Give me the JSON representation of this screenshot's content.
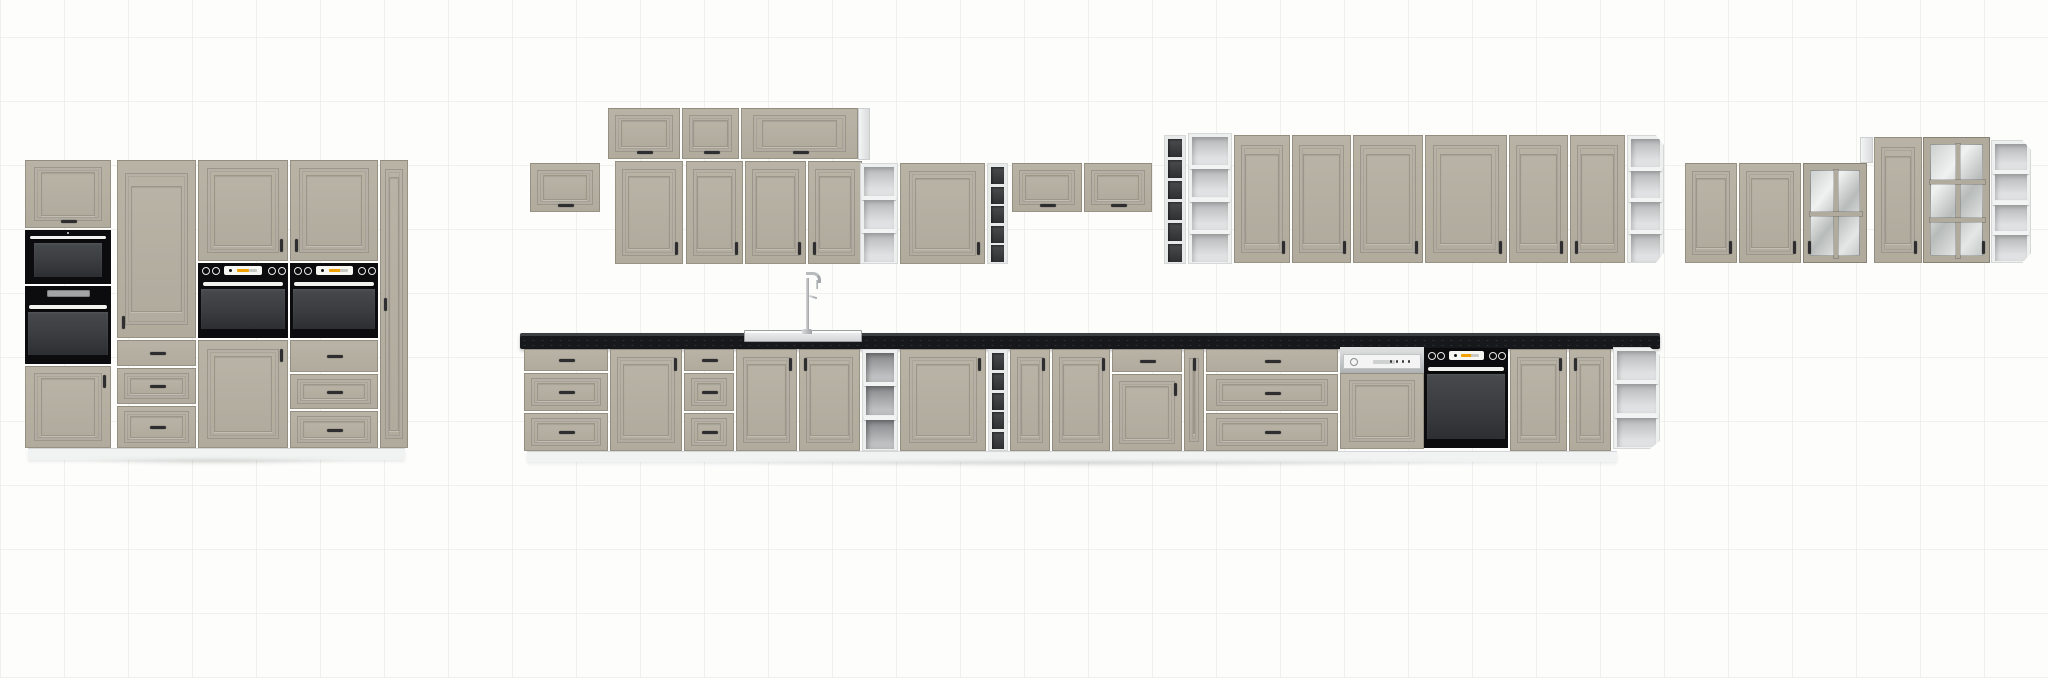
{
  "scene": {
    "label": "kitchen-cabinet-set-elevation-render",
    "canvas": {
      "width": 2048,
      "height": 678
    },
    "background": {
      "base": "#fdfdfc",
      "grid_line": "#f1f1ee",
      "grid_size_px": 64
    },
    "palette": {
      "front_hi": "#b9b3a6",
      "front_lo": "#b1ab9e",
      "front_groove": "#9c968a",
      "carcass": "#eef0f0",
      "countertop": "#17181b",
      "countertop_edge": "#3c3e42",
      "appliance_black": "#0c0c0e",
      "oven_glass": "#3e4043",
      "handle": "#2e2e30",
      "steel": "#c3c6c7",
      "display_orange": "#f2a200",
      "plinth": "#f1f3f3",
      "floor_shadow": "rgba(0,0,0,0.12)"
    },
    "modules": [
      {
        "t": "flap",
        "x": 25,
        "y": 160,
        "w": 86,
        "h": 68,
        "hd": "hbc"
      },
      {
        "t": "microwave",
        "x": 25,
        "y": 230,
        "w": 86,
        "h": 54
      },
      {
        "t": "oven",
        "x": 25,
        "y": 286,
        "w": 86,
        "h": 78,
        "style": "display"
      },
      {
        "t": "door",
        "x": 25,
        "y": 366,
        "w": 86,
        "h": 82,
        "hd": "vtr"
      },
      {
        "t": "door",
        "x": 117,
        "y": 160,
        "w": 79,
        "h": 178,
        "hd": "vbl"
      },
      {
        "t": "drawers",
        "x": 117,
        "y": 340,
        "w": 79,
        "h": 108,
        "rows": [
          [
            0,
            26,
            0
          ],
          [
            28,
            36,
            1
          ],
          [
            66,
            42,
            1
          ]
        ]
      },
      {
        "t": "door",
        "x": 198,
        "y": 160,
        "w": 90,
        "h": 101,
        "hd": "vbr"
      },
      {
        "t": "oven",
        "x": 198,
        "y": 263,
        "w": 90,
        "h": 75,
        "style": "knobs"
      },
      {
        "t": "door",
        "x": 198,
        "y": 340,
        "w": 90,
        "h": 108,
        "hd": "vtr"
      },
      {
        "t": "door",
        "x": 290,
        "y": 160,
        "w": 88,
        "h": 101,
        "hd": "vbl"
      },
      {
        "t": "oven",
        "x": 290,
        "y": 263,
        "w": 88,
        "h": 75,
        "style": "knobs"
      },
      {
        "t": "drawers",
        "x": 290,
        "y": 340,
        "w": 88,
        "h": 108,
        "rows": [
          [
            0,
            32,
            0
          ],
          [
            34,
            35,
            1
          ],
          [
            71,
            37,
            1
          ]
        ]
      },
      {
        "t": "door",
        "x": 380,
        "y": 160,
        "w": 28,
        "h": 288,
        "hd": "vml",
        "slim": 1
      },
      {
        "t": "plinth",
        "x": 28,
        "y": 448,
        "w": 377,
        "h": 12
      },
      {
        "t": "shadow",
        "x": 18,
        "y": 459,
        "w": 397,
        "h": 9
      },
      {
        "t": "flap",
        "x": 530,
        "y": 163,
        "w": 70,
        "h": 49,
        "hd": "hbc"
      },
      {
        "t": "flap",
        "x": 608,
        "y": 108,
        "w": 72,
        "h": 51,
        "hd": "hbc"
      },
      {
        "t": "flap",
        "x": 682,
        "y": 108,
        "w": 57,
        "h": 51,
        "hd": "hbc"
      },
      {
        "t": "flap",
        "x": 741,
        "y": 108,
        "w": 117,
        "h": 51,
        "hd": "hbc"
      },
      {
        "t": "side",
        "x": 858,
        "y": 108,
        "w": 12,
        "h": 52
      },
      {
        "t": "door",
        "x": 615,
        "y": 161,
        "w": 68,
        "h": 103,
        "hd": "vbr"
      },
      {
        "t": "door",
        "x": 686,
        "y": 161,
        "w": 57,
        "h": 103,
        "hd": "vbr"
      },
      {
        "t": "door",
        "x": 745,
        "y": 161,
        "w": 61,
        "h": 103,
        "hd": "vbr"
      },
      {
        "t": "door",
        "x": 808,
        "y": 161,
        "w": 54,
        "h": 103,
        "hd": "vbl"
      },
      {
        "t": "openshelf",
        "x": 860,
        "y": 163,
        "w": 38,
        "h": 101,
        "cells": 3,
        "interior": "light"
      },
      {
        "t": "door",
        "x": 900,
        "y": 163,
        "w": 85,
        "h": 101,
        "hd": "vbr"
      },
      {
        "t": "cubbies",
        "x": 987,
        "y": 163,
        "w": 21,
        "h": 101,
        "cells": 5
      },
      {
        "t": "flap",
        "x": 1012,
        "y": 163,
        "w": 70,
        "h": 49,
        "hd": "hbc"
      },
      {
        "t": "flap",
        "x": 1084,
        "y": 163,
        "w": 68,
        "h": 49,
        "hd": "hbc"
      },
      {
        "t": "cubbies",
        "x": 1164,
        "y": 135,
        "w": 22,
        "h": 129,
        "cells": 6
      },
      {
        "t": "openshelf",
        "x": 1188,
        "y": 133,
        "w": 44,
        "h": 131,
        "cells": 4,
        "interior": "light"
      },
      {
        "t": "door",
        "x": 1234,
        "y": 135,
        "w": 56,
        "h": 128,
        "hd": "vbr"
      },
      {
        "t": "door",
        "x": 1292,
        "y": 135,
        "w": 59,
        "h": 128,
        "hd": "vbr"
      },
      {
        "t": "door",
        "x": 1353,
        "y": 135,
        "w": 70,
        "h": 128,
        "hd": "vbr"
      },
      {
        "t": "door",
        "x": 1425,
        "y": 135,
        "w": 82,
        "h": 128,
        "hd": "vbr"
      },
      {
        "t": "door",
        "x": 1509,
        "y": 135,
        "w": 59,
        "h": 128,
        "hd": "vbr"
      },
      {
        "t": "door",
        "x": 1570,
        "y": 135,
        "w": 55,
        "h": 128,
        "hd": "vbl"
      },
      {
        "t": "openshelf",
        "x": 1627,
        "y": 135,
        "w": 37,
        "h": 128,
        "cells": 4,
        "interior": "light",
        "corner": 1
      },
      {
        "t": "door",
        "x": 1685,
        "y": 163,
        "w": 52,
        "h": 100,
        "hd": "vbr"
      },
      {
        "t": "door",
        "x": 1739,
        "y": 163,
        "w": 62,
        "h": 100,
        "hd": "vbr"
      },
      {
        "t": "glass",
        "x": 1803,
        "y": 163,
        "w": 64,
        "h": 100,
        "cols": 2,
        "rows": 2,
        "hd": "vbl"
      },
      {
        "t": "side",
        "x": 1860,
        "y": 137,
        "w": 13,
        "h": 26
      },
      {
        "t": "door",
        "x": 1874,
        "y": 137,
        "w": 48,
        "h": 126,
        "hd": "vbr"
      },
      {
        "t": "glass",
        "x": 1923,
        "y": 137,
        "w": 67,
        "h": 126,
        "cols": 2,
        "rows": 3,
        "hd": "vbr"
      },
      {
        "t": "openshelf",
        "x": 1991,
        "y": 140,
        "w": 40,
        "h": 123,
        "cells": 4,
        "interior": "light",
        "corner": 1
      },
      {
        "t": "counter",
        "x": 520,
        "y": 333,
        "w": 1140,
        "h": 16
      },
      {
        "t": "sink",
        "x": 744,
        "y": 330,
        "w": 118,
        "h": 12
      },
      {
        "t": "faucet",
        "x": 794,
        "y": 272,
        "w": 26,
        "h": 62
      },
      {
        "t": "drawers",
        "x": 524,
        "y": 349,
        "w": 84,
        "h": 102,
        "rows": [
          [
            0,
            22,
            0
          ],
          [
            24,
            38,
            1
          ],
          [
            64,
            38,
            1
          ]
        ]
      },
      {
        "t": "door",
        "x": 610,
        "y": 349,
        "w": 72,
        "h": 102,
        "hd": "vtr"
      },
      {
        "t": "drawers",
        "x": 684,
        "y": 349,
        "w": 50,
        "h": 102,
        "rows": [
          [
            0,
            22,
            0
          ],
          [
            24,
            38,
            1
          ],
          [
            64,
            38,
            1
          ]
        ]
      },
      {
        "t": "door",
        "x": 736,
        "y": 349,
        "w": 61,
        "h": 102,
        "hd": "vtr"
      },
      {
        "t": "door",
        "x": 799,
        "y": 349,
        "w": 61,
        "h": 102,
        "hd": "vtl"
      },
      {
        "t": "openshelf",
        "x": 862,
        "y": 349,
        "w": 36,
        "h": 102,
        "cells": 3,
        "interior": "dim"
      },
      {
        "t": "door",
        "x": 900,
        "y": 349,
        "w": 86,
        "h": 102,
        "hd": "vtr"
      },
      {
        "t": "cubbies",
        "x": 988,
        "y": 349,
        "w": 20,
        "h": 102,
        "cells": 5
      },
      {
        "t": "door",
        "x": 1010,
        "y": 349,
        "w": 40,
        "h": 102,
        "hd": "vtr"
      },
      {
        "t": "door",
        "x": 1052,
        "y": 349,
        "w": 58,
        "h": 102,
        "hd": "vtr"
      },
      {
        "t": "drawerdoor",
        "x": 1112,
        "y": 349,
        "w": 70,
        "h": 102,
        "drawer_h": 23,
        "hd": "vtr"
      },
      {
        "t": "door",
        "x": 1184,
        "y": 349,
        "w": 20,
        "h": 102,
        "hd": "vtc",
        "slim": 1
      },
      {
        "t": "drawers",
        "x": 1206,
        "y": 349,
        "w": 132,
        "h": 102,
        "rows": [
          [
            0,
            23,
            0
          ],
          [
            25,
            37,
            1
          ],
          [
            64,
            38,
            1
          ]
        ]
      },
      {
        "t": "dishwasher",
        "x": 1340,
        "y": 347,
        "w": 84,
        "h": 102
      },
      {
        "t": "oven",
        "x": 1424,
        "y": 348,
        "w": 84,
        "h": 100,
        "style": "knobs",
        "base": 1
      },
      {
        "t": "door",
        "x": 1510,
        "y": 349,
        "w": 57,
        "h": 102,
        "hd": "vtr"
      },
      {
        "t": "door",
        "x": 1569,
        "y": 349,
        "w": 42,
        "h": 102,
        "hd": "vtl"
      },
      {
        "t": "openshelf",
        "x": 1613,
        "y": 347,
        "w": 47,
        "h": 102,
        "cells": 3,
        "interior": "light",
        "corner": 1
      },
      {
        "t": "plinth",
        "x": 527,
        "y": 451,
        "w": 1090,
        "h": 11
      },
      {
        "t": "shadow",
        "x": 516,
        "y": 461,
        "w": 1148,
        "h": 9
      }
    ]
  }
}
